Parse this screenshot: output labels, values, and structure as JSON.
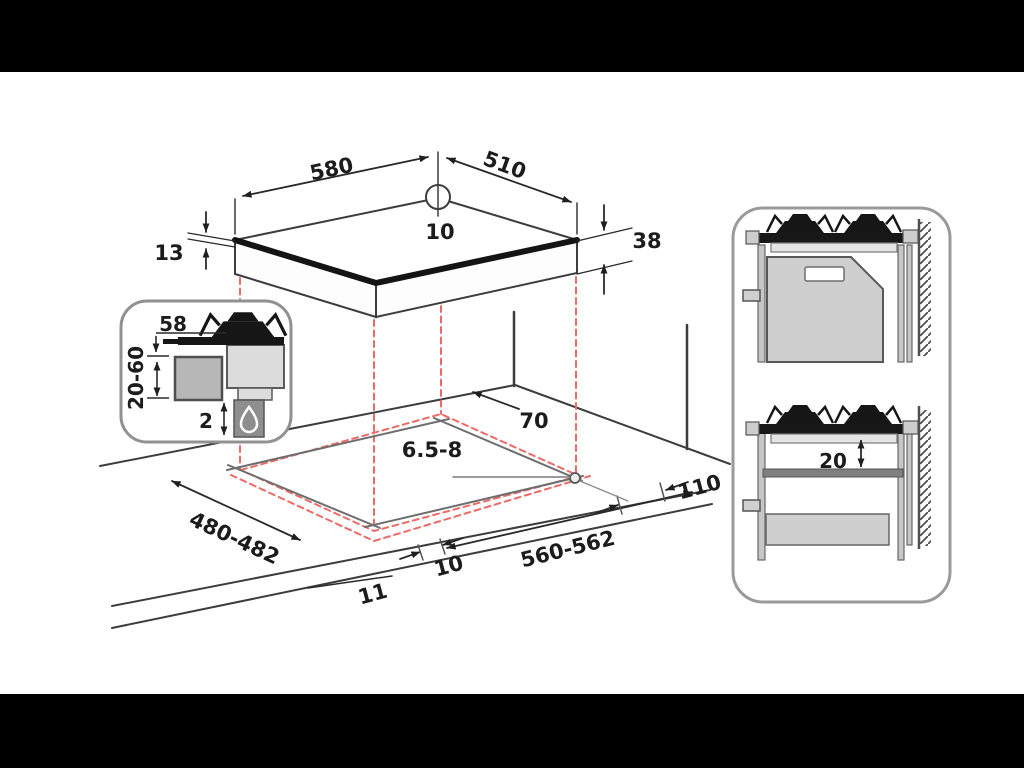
{
  "page": {
    "background": "#000000",
    "canvas_background": "#ffffff"
  },
  "colors": {
    "line": "#3d3d3d",
    "cutout_line": "#6e6e6e",
    "red_dashed": "#ee6a66",
    "fill_light_gray": "#cfcfcf",
    "fill_mid_gray": "#b7b7b7",
    "fill_dark_gray": "#828282",
    "ink_black": "#161616",
    "text": "#1c1c1c"
  },
  "hob_top_view": {
    "width_label": "580",
    "depth_label": "510",
    "center_hole_label": "10",
    "edge_thickness_label": "13",
    "height_label": "38"
  },
  "burner_detail_inset": {
    "burner_height_label": "58",
    "worktop_range_label": "20-60",
    "clearance_label": "2"
  },
  "worktop_cutout_view": {
    "rear_clearance_label": "70",
    "hole_diameter_label": "6.5-8",
    "side_clearance_label": "110",
    "cutout_depth_label": "480-482",
    "cutout_width_label": "560-562",
    "front_gap_label": "10",
    "front_edge_label": "11"
  },
  "side_views_panel": {
    "shelf_gap_label": "20"
  }
}
